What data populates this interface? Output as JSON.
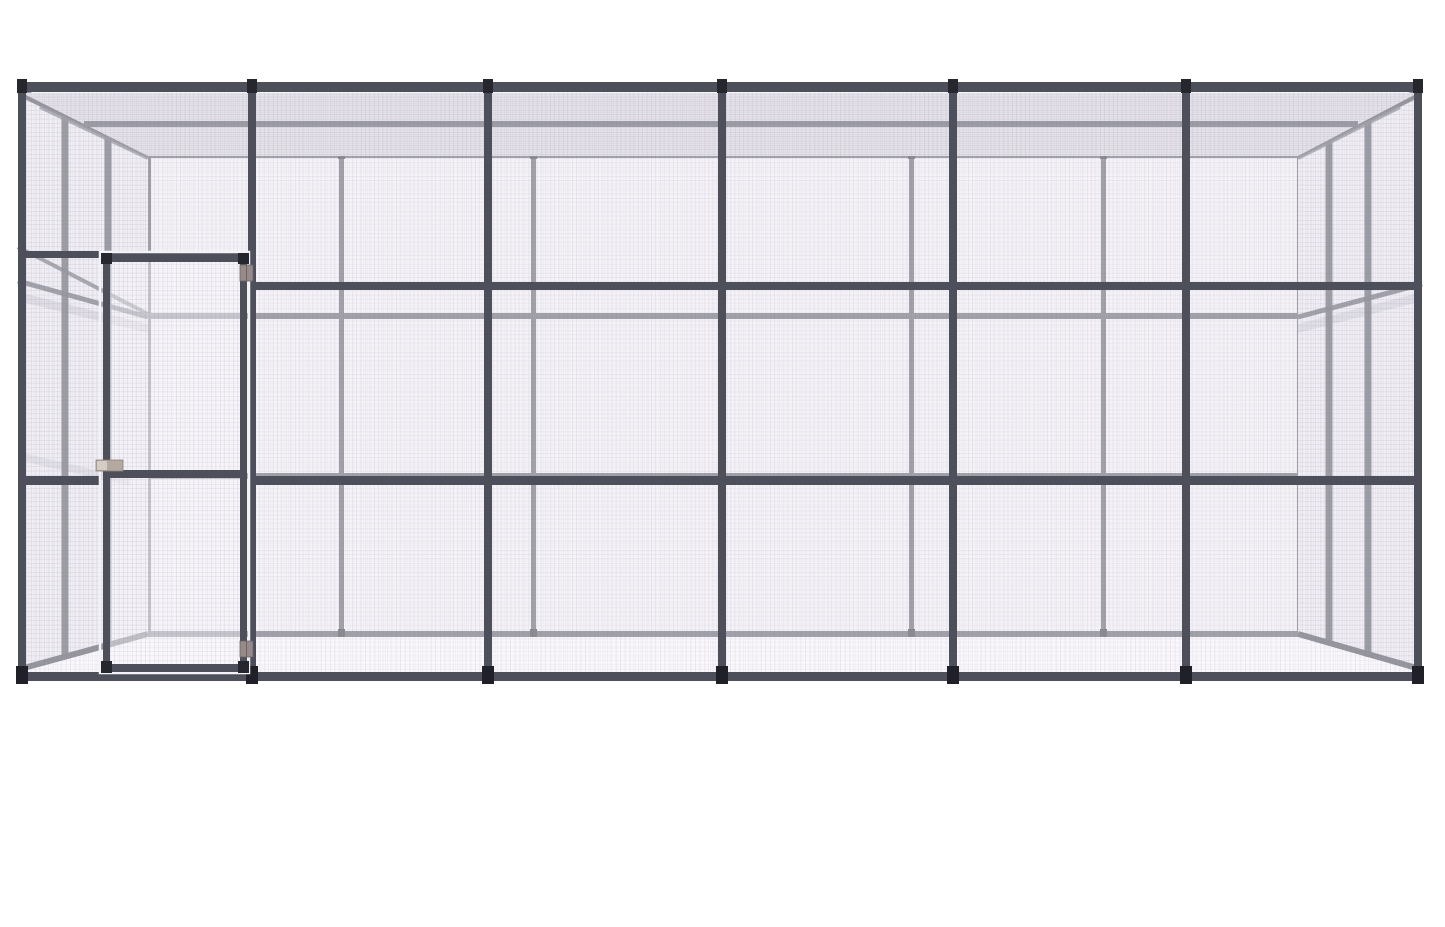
{
  "canvas": {
    "width": 1445,
    "height": 927,
    "background": "#ffffff"
  },
  "scene": {
    "description": "3D product render of a large walk-in steel wire mesh enclosure (aviary cage) with six front bays and a hinged mesh door in the left bay",
    "palette": {
      "frame": "#4d4f5b",
      "frameBack": "#61626f",
      "frameMid": "#575965",
      "capDark": "#26272e",
      "footDark": "#202128",
      "backNub": "#3a3b45",
      "hinge": "#968a8b",
      "hingeEdge": "#6f6368",
      "latch": "#b3a9a1",
      "latchEdge": "#8d837b",
      "latchFace": "#d4cdc6",
      "gapLight": "#f3f3f7",
      "meshWall": "#f2f0f5",
      "meshSide": "#eae7ef",
      "meshRoof": "#d8d3dd",
      "meshFloor": "#f8f7fa"
    },
    "elements": [
      {
        "n": "back-wall-mesh",
        "t": "rect",
        "x": 146,
        "y": 155,
        "w": 1156,
        "h": 482,
        "f": "url(#meshBack)"
      },
      {
        "n": "back-top-rail",
        "t": "rect",
        "x": 146,
        "y": 151,
        "w": 1156,
        "h": 7,
        "f": "$frameBack"
      },
      {
        "n": "back-upper-rail",
        "t": "rect",
        "x": 146,
        "y": 313,
        "w": 1156,
        "h": 6,
        "f": "$frameBack"
      },
      {
        "n": "back-mid-rail",
        "t": "rect",
        "x": 146,
        "y": 473,
        "w": 1156,
        "h": 6,
        "f": "$frameBack"
      },
      {
        "n": "back-bottom-rail",
        "t": "rect",
        "x": 146,
        "y": 631,
        "w": 1156,
        "h": 6,
        "f": "$frameBack"
      },
      {
        "n": "back-corner-post-left",
        "t": "rect",
        "x": 146,
        "y": 155,
        "w": 5,
        "h": 482,
        "f": "$frameBack"
      },
      {
        "n": "back-post",
        "t": "rect",
        "x": 339,
        "y": 155,
        "w": 5,
        "h": 482,
        "f": "$frameBack"
      },
      {
        "n": "back-post",
        "t": "rect",
        "x": 531,
        "y": 155,
        "w": 5,
        "h": 482,
        "f": "$frameBack"
      },
      {
        "n": "back-post",
        "t": "rect",
        "x": 909,
        "y": 155,
        "w": 5,
        "h": 482,
        "f": "$frameBack"
      },
      {
        "n": "back-post",
        "t": "rect",
        "x": 1101,
        "y": 155,
        "w": 5,
        "h": 482,
        "f": "$frameBack"
      },
      {
        "n": "back-corner-post-right",
        "t": "rect",
        "x": 1297,
        "y": 155,
        "w": 5,
        "h": 482,
        "f": "$frameBack"
      },
      {
        "n": "back-post-cap",
        "t": "rect",
        "x": 338,
        "y": 151,
        "w": 7,
        "h": 8,
        "f": "$backNub"
      },
      {
        "n": "back-post-cap",
        "t": "rect",
        "x": 530,
        "y": 151,
        "w": 7,
        "h": 8,
        "f": "$backNub"
      },
      {
        "n": "back-post-cap",
        "t": "rect",
        "x": 908,
        "y": 151,
        "w": 7,
        "h": 8,
        "f": "$backNub"
      },
      {
        "n": "back-post-cap",
        "t": "rect",
        "x": 1100,
        "y": 151,
        "w": 7,
        "h": 8,
        "f": "$backNub"
      },
      {
        "n": "back-post-foot",
        "t": "rect",
        "x": 338,
        "y": 629,
        "w": 7,
        "h": 8,
        "f": "$backNub"
      },
      {
        "n": "back-post-foot",
        "t": "rect",
        "x": 530,
        "y": 629,
        "w": 7,
        "h": 8,
        "f": "$backNub"
      },
      {
        "n": "back-post-foot",
        "t": "rect",
        "x": 908,
        "y": 629,
        "w": 7,
        "h": 8,
        "f": "$backNub"
      },
      {
        "n": "back-post-foot",
        "t": "rect",
        "x": 1100,
        "y": 629,
        "w": 7,
        "h": 8,
        "f": "$backNub"
      },
      {
        "n": "left-wall-mesh",
        "t": "poly",
        "pts": "24,95 148,157 148,636 24,670",
        "f": "url(#meshSide)"
      },
      {
        "n": "left-wall-header-rail",
        "t": "line",
        "x1": 18,
        "y1": 247,
        "x2": 148,
        "y2": 314,
        "s": "$frameBack",
        "sw": 4,
        "o": 0.9
      },
      {
        "n": "left-wall-upper-rail",
        "t": "line",
        "x1": 18,
        "y1": 281,
        "x2": 148,
        "y2": 317,
        "s": "$frameBack",
        "sw": 5
      },
      {
        "n": "left-wall-shadow-upper",
        "t": "poly",
        "pts": "18,292 148,324 148,333 18,301",
        "f": "rgba(90,88,108,0.20)"
      },
      {
        "n": "left-wall-shadow-lower",
        "t": "poly",
        "pts": "18,452 130,478 130,486 18,460",
        "f": "rgba(90,88,108,0.16)"
      },
      {
        "n": "left-wall-post-front",
        "t": "line",
        "x1": 65,
        "y1": 112,
        "x2": 65,
        "y2": 659,
        "s": "$frame",
        "sw": 7,
        "o": 0.92
      },
      {
        "n": "left-wall-post-rear",
        "t": "line",
        "x1": 108,
        "y1": 134,
        "x2": 108,
        "y2": 648,
        "s": "$frame",
        "sw": 7,
        "o": 0.92
      },
      {
        "n": "left-wall-top-beam",
        "t": "poly",
        "pts": "18,86 148,150 148,158 18,96",
        "f": "$frame"
      },
      {
        "n": "left-roof-edge",
        "t": "line",
        "x1": 40,
        "y1": 107,
        "x2": 148,
        "y2": 158,
        "s": "$frameBack",
        "sw": 4,
        "o": 0.8
      },
      {
        "n": "left-wall-bottom-beam",
        "t": "line",
        "x1": 20,
        "y1": 669,
        "x2": 148,
        "y2": 634,
        "s": "$frame",
        "sw": 6
      },
      {
        "n": "right-wall-mesh",
        "t": "poly",
        "pts": "1416,95 1298,157 1298,636 1416,670",
        "f": "url(#meshSide)"
      },
      {
        "n": "right-wall-upper-rail",
        "t": "line",
        "x1": 1422,
        "y1": 284,
        "x2": 1298,
        "y2": 317,
        "s": "$frameBack",
        "sw": 5
      },
      {
        "n": "right-wall-shadow-upper",
        "t": "poly",
        "pts": "1422,292 1298,324 1298,333 1422,301",
        "f": "rgba(90,88,108,0.18)"
      },
      {
        "n": "right-wall-post-front",
        "t": "line",
        "x1": 1368,
        "y1": 119,
        "x2": 1368,
        "y2": 657,
        "s": "$frame",
        "sw": 7,
        "o": 0.92
      },
      {
        "n": "right-wall-post-rear",
        "t": "line",
        "x1": 1329,
        "y1": 140,
        "x2": 1329,
        "y2": 646,
        "s": "$frame",
        "sw": 7,
        "o": 0.92
      },
      {
        "n": "right-wall-top-beam",
        "t": "poly",
        "pts": "1422,86 1298,150 1298,158 1422,96",
        "f": "$frame"
      },
      {
        "n": "right-roof-edge",
        "t": "line",
        "x1": 1400,
        "y1": 107,
        "x2": 1298,
        "y2": 158,
        "s": "$frameBack",
        "sw": 4,
        "o": 0.8
      },
      {
        "n": "right-wall-bottom-beam",
        "t": "line",
        "x1": 1420,
        "y1": 669,
        "x2": 1298,
        "y2": 634,
        "s": "$frame",
        "sw": 6
      },
      {
        "n": "floor-mesh",
        "t": "poly",
        "pts": "22,672 148,637 1298,637 1418,672",
        "f": "url(#meshFloor)"
      },
      {
        "n": "roof-mesh",
        "t": "poly",
        "pts": "22,93 1418,93 1298,156 148,156",
        "f": "url(#meshRoof)"
      },
      {
        "n": "roof-purlin",
        "t": "line",
        "x1": 84,
        "y1": 124,
        "x2": 1358,
        "y2": 124,
        "s": "$frameMid",
        "sw": 6
      },
      {
        "n": "roof-beam",
        "t": "line",
        "x1": 252,
        "y1": 94,
        "x2": 252,
        "y2": 154,
        "s": "$frameMid",
        "sw": 6
      },
      {
        "n": "roof-beam",
        "t": "line",
        "x1": 488,
        "y1": 94,
        "x2": 488,
        "y2": 154,
        "s": "$frameMid",
        "sw": 6
      },
      {
        "n": "roof-beam",
        "t": "line",
        "x1": 722,
        "y1": 94,
        "x2": 722,
        "y2": 154,
        "s": "$frameMid",
        "sw": 6
      },
      {
        "n": "roof-beam",
        "t": "line",
        "x1": 953,
        "y1": 94,
        "x2": 953,
        "y2": 154,
        "s": "$frameMid",
        "sw": 6
      },
      {
        "n": "roof-beam",
        "t": "line",
        "x1": 1186,
        "y1": 94,
        "x2": 1186,
        "y2": 154,
        "s": "$frameMid",
        "sw": 6
      },
      {
        "n": "front-mesh",
        "t": "rect",
        "x": 18,
        "y": 92,
        "w": 1404,
        "h": 580,
        "f": "url(#meshFront)"
      },
      {
        "n": "front-top-rail",
        "t": "rect",
        "x": 18,
        "y": 82,
        "w": 1404,
        "h": 10,
        "f": "$frame"
      },
      {
        "n": "door-header-rail",
        "t": "rect",
        "x": 18,
        "y": 251,
        "w": 236,
        "h": 7,
        "f": "$frame"
      },
      {
        "n": "front-upper-rail",
        "t": "rect",
        "x": 248,
        "y": 282,
        "w": 1174,
        "h": 8,
        "f": "$frame"
      },
      {
        "n": "front-mid-rail-left",
        "t": "rect",
        "x": 18,
        "y": 476,
        "w": 82,
        "h": 9,
        "f": "$frame"
      },
      {
        "n": "front-mid-rail",
        "t": "rect",
        "x": 249,
        "y": 476,
        "w": 1173,
        "h": 9,
        "f": "$frame"
      },
      {
        "n": "front-bottom-rail",
        "t": "rect",
        "x": 18,
        "y": 672,
        "w": 1404,
        "h": 9,
        "f": "$frame"
      },
      {
        "n": "front-post",
        "t": "rect",
        "x": 18,
        "y": 82,
        "w": 8,
        "h": 599,
        "f": "$frame"
      },
      {
        "n": "front-post",
        "t": "rect",
        "x": 248,
        "y": 82,
        "w": 8,
        "h": 599,
        "f": "$frame"
      },
      {
        "n": "front-post",
        "t": "rect",
        "x": 484,
        "y": 82,
        "w": 8,
        "h": 599,
        "f": "$frame"
      },
      {
        "n": "front-post",
        "t": "rect",
        "x": 718,
        "y": 82,
        "w": 8,
        "h": 599,
        "f": "$frame"
      },
      {
        "n": "front-post",
        "t": "rect",
        "x": 949,
        "y": 82,
        "w": 8,
        "h": 599,
        "f": "$frame"
      },
      {
        "n": "front-post",
        "t": "rect",
        "x": 1182,
        "y": 82,
        "w": 8,
        "h": 599,
        "f": "$frame"
      },
      {
        "n": "front-post",
        "t": "rect",
        "x": 1414,
        "y": 82,
        "w": 8,
        "h": 599,
        "f": "$frame"
      },
      {
        "n": "post-cap",
        "t": "rect",
        "x": 17,
        "y": 79,
        "w": 10,
        "h": 14,
        "f": "$capDark"
      },
      {
        "n": "post-cap",
        "t": "rect",
        "x": 247,
        "y": 79,
        "w": 10,
        "h": 14,
        "f": "$capDark"
      },
      {
        "n": "post-cap",
        "t": "rect",
        "x": 483,
        "y": 79,
        "w": 10,
        "h": 14,
        "f": "$capDark"
      },
      {
        "n": "post-cap",
        "t": "rect",
        "x": 717,
        "y": 79,
        "w": 10,
        "h": 14,
        "f": "$capDark"
      },
      {
        "n": "post-cap",
        "t": "rect",
        "x": 948,
        "y": 79,
        "w": 10,
        "h": 14,
        "f": "$capDark"
      },
      {
        "n": "post-cap",
        "t": "rect",
        "x": 1181,
        "y": 79,
        "w": 10,
        "h": 14,
        "f": "$capDark"
      },
      {
        "n": "post-cap",
        "t": "rect",
        "x": 1413,
        "y": 79,
        "w": 10,
        "h": 14,
        "f": "$capDark"
      },
      {
        "n": "post-foot",
        "t": "rect",
        "x": 16,
        "y": 666,
        "w": 12,
        "h": 18,
        "f": "$footDark"
      },
      {
        "n": "post-foot",
        "t": "rect",
        "x": 246,
        "y": 666,
        "w": 12,
        "h": 18,
        "f": "$footDark"
      },
      {
        "n": "post-foot",
        "t": "rect",
        "x": 482,
        "y": 666,
        "w": 12,
        "h": 18,
        "f": "$footDark"
      },
      {
        "n": "post-foot",
        "t": "rect",
        "x": 716,
        "y": 666,
        "w": 12,
        "h": 18,
        "f": "$footDark"
      },
      {
        "n": "post-foot",
        "t": "rect",
        "x": 947,
        "y": 666,
        "w": 12,
        "h": 18,
        "f": "$footDark"
      },
      {
        "n": "post-foot",
        "t": "rect",
        "x": 1180,
        "y": 666,
        "w": 12,
        "h": 18,
        "f": "$footDark"
      },
      {
        "n": "post-foot",
        "t": "rect",
        "x": 1412,
        "y": 666,
        "w": 12,
        "h": 18,
        "f": "$footDark"
      },
      {
        "n": "door-gap",
        "t": "rect",
        "x": 100,
        "y": 252,
        "w": 149,
        "h": 421,
        "f": "none",
        "s": "$gapLight",
        "sw": 2.5
      },
      {
        "n": "door-mesh",
        "t": "rect",
        "x": 106,
        "y": 258,
        "w": 138,
        "h": 410,
        "f": "url(#meshFront)"
      },
      {
        "n": "door-stile-left",
        "t": "rect",
        "x": 103,
        "y": 255,
        "w": 7,
        "h": 417,
        "f": "$frame"
      },
      {
        "n": "door-stile-right",
        "t": "rect",
        "x": 240,
        "y": 255,
        "w": 7,
        "h": 417,
        "f": "$frame"
      },
      {
        "n": "door-top-rail",
        "t": "rect",
        "x": 103,
        "y": 255,
        "w": 144,
        "h": 7,
        "f": "$frame"
      },
      {
        "n": "door-mid-rail",
        "t": "rect",
        "x": 103,
        "y": 470,
        "w": 144,
        "h": 8,
        "f": "$frame"
      },
      {
        "n": "door-bottom-rail",
        "t": "rect",
        "x": 103,
        "y": 664,
        "w": 144,
        "h": 8,
        "f": "$frame"
      },
      {
        "n": "door-corner-cap",
        "t": "rect",
        "x": 101,
        "y": 253,
        "w": 11,
        "h": 11,
        "f": "$capDark"
      },
      {
        "n": "door-corner-cap",
        "t": "rect",
        "x": 238,
        "y": 253,
        "w": 11,
        "h": 11,
        "f": "$capDark"
      },
      {
        "n": "door-corner-cap",
        "t": "rect",
        "x": 101,
        "y": 661,
        "w": 11,
        "h": 12,
        "f": "$capDark"
      },
      {
        "n": "door-corner-cap",
        "t": "rect",
        "x": 238,
        "y": 661,
        "w": 11,
        "h": 12,
        "f": "$capDark"
      },
      {
        "n": "door-hinge-top",
        "t": "rect",
        "x": 240,
        "y": 265,
        "w": 13,
        "h": 16,
        "f": "$hinge",
        "s": "$hingeEdge",
        "sw": 0.8
      },
      {
        "n": "door-hinge-top-knuckle",
        "t": "line",
        "x1": 246.5,
        "y1": 265,
        "x2": 246.5,
        "y2": 281,
        "s": "$hingeEdge",
        "sw": 1
      },
      {
        "n": "door-hinge-bottom",
        "t": "rect",
        "x": 240,
        "y": 641,
        "w": 13,
        "h": 16,
        "f": "$hinge",
        "s": "$hingeEdge",
        "sw": 0.8
      },
      {
        "n": "door-hinge-bottom-knuckle",
        "t": "line",
        "x1": 246.5,
        "y1": 641,
        "x2": 246.5,
        "y2": 657,
        "s": "$hingeEdge",
        "sw": 1
      },
      {
        "n": "door-latch",
        "t": "rect",
        "x": 96,
        "y": 460,
        "w": 27,
        "h": 11,
        "f": "$latch",
        "s": "$latchEdge",
        "sw": 0.8
      },
      {
        "n": "door-latch-face",
        "t": "rect",
        "x": 97,
        "y": 461,
        "w": 10,
        "h": 9,
        "f": "$latchFace"
      }
    ]
  }
}
